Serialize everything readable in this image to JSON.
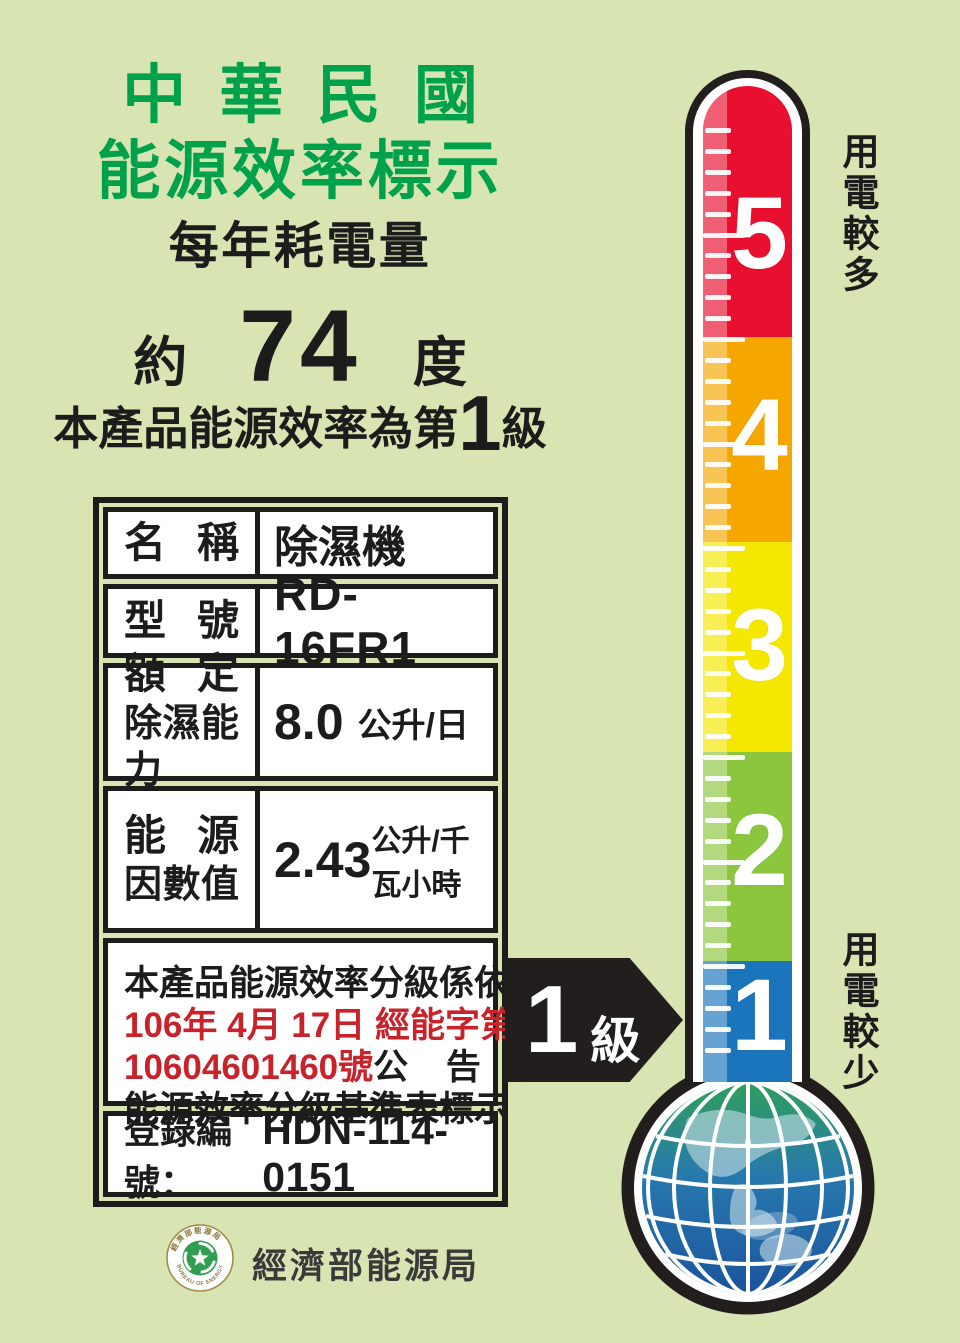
{
  "header": {
    "title_line1": "中華民國",
    "title_line2": "能源效率標示",
    "subtitle": "每年耗電量",
    "title_color": "#00A14B",
    "consumption": {
      "prefix": "約",
      "value": "74",
      "unit": "度"
    },
    "grade_line": {
      "prefix": "本產品能源效率為第",
      "grade": "1",
      "suffix": "級"
    }
  },
  "spec_table": {
    "rows": [
      {
        "label": "名稱",
        "value": "除濕機"
      },
      {
        "label": "型號",
        "value": "RD-16FR1"
      },
      {
        "label_line1": "額定",
        "label_line2": "除濕能力",
        "value": "8.0",
        "unit": "公升/日"
      },
      {
        "label_line1": "能源",
        "label_line2": "因數值",
        "value": "2.43",
        "unit": "公升/千瓦小時"
      }
    ],
    "notice": {
      "line1": "本產品能源效率分級係依經濟部",
      "line2": "106年 4月 17日 經能字第",
      "line3_red": "10604601460號",
      "line3_black": "公 告 之",
      "line4": "能源效率分級基準表標示",
      "red_color": "#C8232B"
    },
    "registration": {
      "label": "登錄編號：",
      "value": "HDN-114-0151"
    }
  },
  "thermometer": {
    "levels": [
      {
        "value": "5",
        "color": "#E8102E"
      },
      {
        "value": "4",
        "color": "#F5A700"
      },
      {
        "value": "3",
        "color": "#F5E800"
      },
      {
        "value": "2",
        "color": "#8CC63F"
      },
      {
        "value": "1",
        "color": "#1B75BC"
      }
    ],
    "label_top": "用電較多",
    "label_bottom": "用電較少",
    "pointer": {
      "grade": "1",
      "suffix": "級"
    }
  },
  "footer": {
    "agency_name": "經濟部能源局",
    "seal_top_text": "經濟部能源局",
    "seal_bottom_text": "BUREAU OF ENERGY"
  },
  "page": {
    "background": "#D8E4B2"
  }
}
